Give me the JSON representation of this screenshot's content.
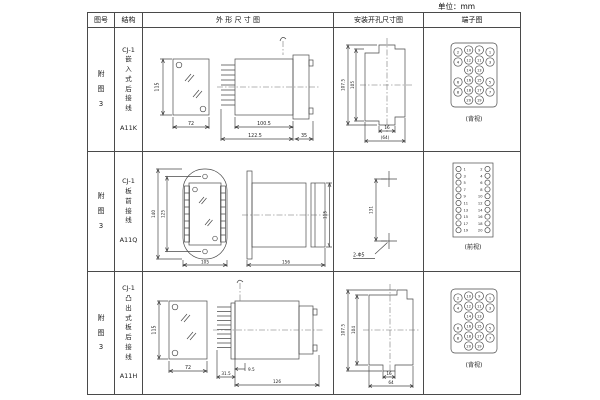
{
  "unit_label": "单位：mm",
  "table": {
    "headers": {
      "fig_no": "图号",
      "structure": "结构",
      "outline": "外 形 尺 寸 图",
      "install": "安装开孔尺寸图",
      "terminal": "端子图"
    },
    "rows": [
      {
        "figure": "附\n图\n3",
        "structure": "CJ-1\n嵌\n入\n式\n后\n接\n线\n\nA11K",
        "outline_dims": {
          "height": "115",
          "width": "72",
          "depth1": "100.5",
          "depth2": "122.5",
          "cap": "35"
        },
        "install_dims": {
          "outer_h": "107.5",
          "inner_h": "105",
          "slot_w": "16",
          "cutout_w": "(64)"
        },
        "terminal": {
          "matrix": [
            [
              "2",
              "10",
              "9",
              "1"
            ],
            [
              "4",
              "12",
              "11",
              "3"
            ],
            [
              "",
              "14",
              "13",
              ""
            ],
            [
              "6",
              "16",
              "15",
              "5"
            ],
            [
              "8",
              "18",
              "17",
              "7"
            ],
            [
              "",
              "20",
              "19",
              ""
            ]
          ],
          "view_label": "(背视)"
        }
      },
      {
        "figure": "附\n图\n3",
        "structure": "CJ-1\n板\n前\n接\n线\n\nA11Q",
        "outline_dims": {
          "flange_h": "140",
          "inner_h": "125",
          "width": "105",
          "depth": "156",
          "body_h": "115"
        },
        "install_dims": {
          "hole_spacing": "131",
          "holes": "2-Φ5"
        },
        "terminal": {
          "left": [
            "1",
            "3",
            "5",
            "7",
            "9",
            "11",
            "13",
            "15",
            "17",
            "19"
          ],
          "right": [
            "2",
            "4",
            "6",
            "8",
            "10",
            "12",
            "14",
            "16",
            "18",
            "20"
          ],
          "view_label": "(前视)"
        }
      },
      {
        "figure": "附\n图\n3",
        "structure": "CJ-1\n凸\n出\n式\n板\n后\n接\n线\n\nA11H",
        "outline_dims": {
          "height": "115",
          "width": "72",
          "pins": "31.5",
          "gap": "9.5",
          "depth": "126"
        },
        "install_dims": {
          "outer_h": "107.5",
          "inner_h": "104",
          "slot_w": "16",
          "cutout_w": "64"
        },
        "terminal": {
          "matrix": [
            [
              "2",
              "10",
              "9",
              "1"
            ],
            [
              "4",
              "12",
              "11",
              "3"
            ],
            [
              "",
              "14",
              "13",
              ""
            ],
            [
              "6",
              "16",
              "15",
              "5"
            ],
            [
              "8",
              "18",
              "17",
              "7"
            ],
            [
              "",
              "20",
              "19",
              ""
            ]
          ],
          "view_label": "(背视)"
        }
      }
    ]
  }
}
